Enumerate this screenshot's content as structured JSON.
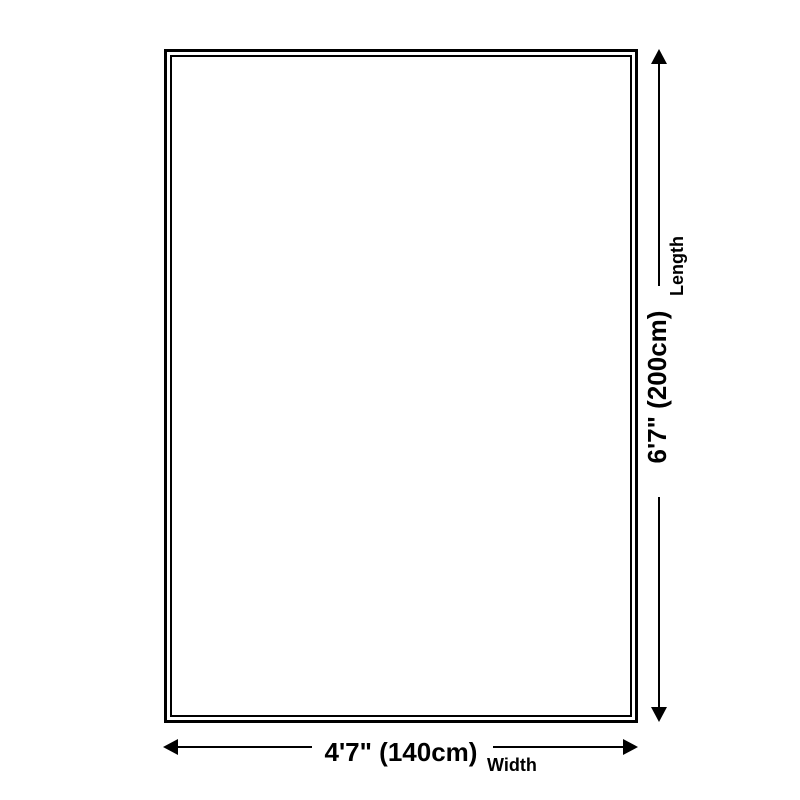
{
  "colors": {
    "background": "#ffffff",
    "line": "#000000",
    "text": "#000000"
  },
  "product_outline": {
    "shape": "rectangle-double-border"
  },
  "dimensions": {
    "length": {
      "value": "6'7\" (200cm)",
      "label": "Length"
    },
    "width": {
      "value": "4'7\" (140cm)",
      "label": "Width"
    }
  },
  "icons": {
    "length_arrow_top": "arrow-up-icon",
    "length_arrow_bottom": "arrow-down-icon",
    "width_arrow_left": "arrow-left-icon",
    "width_arrow_right": "arrow-right-icon"
  }
}
